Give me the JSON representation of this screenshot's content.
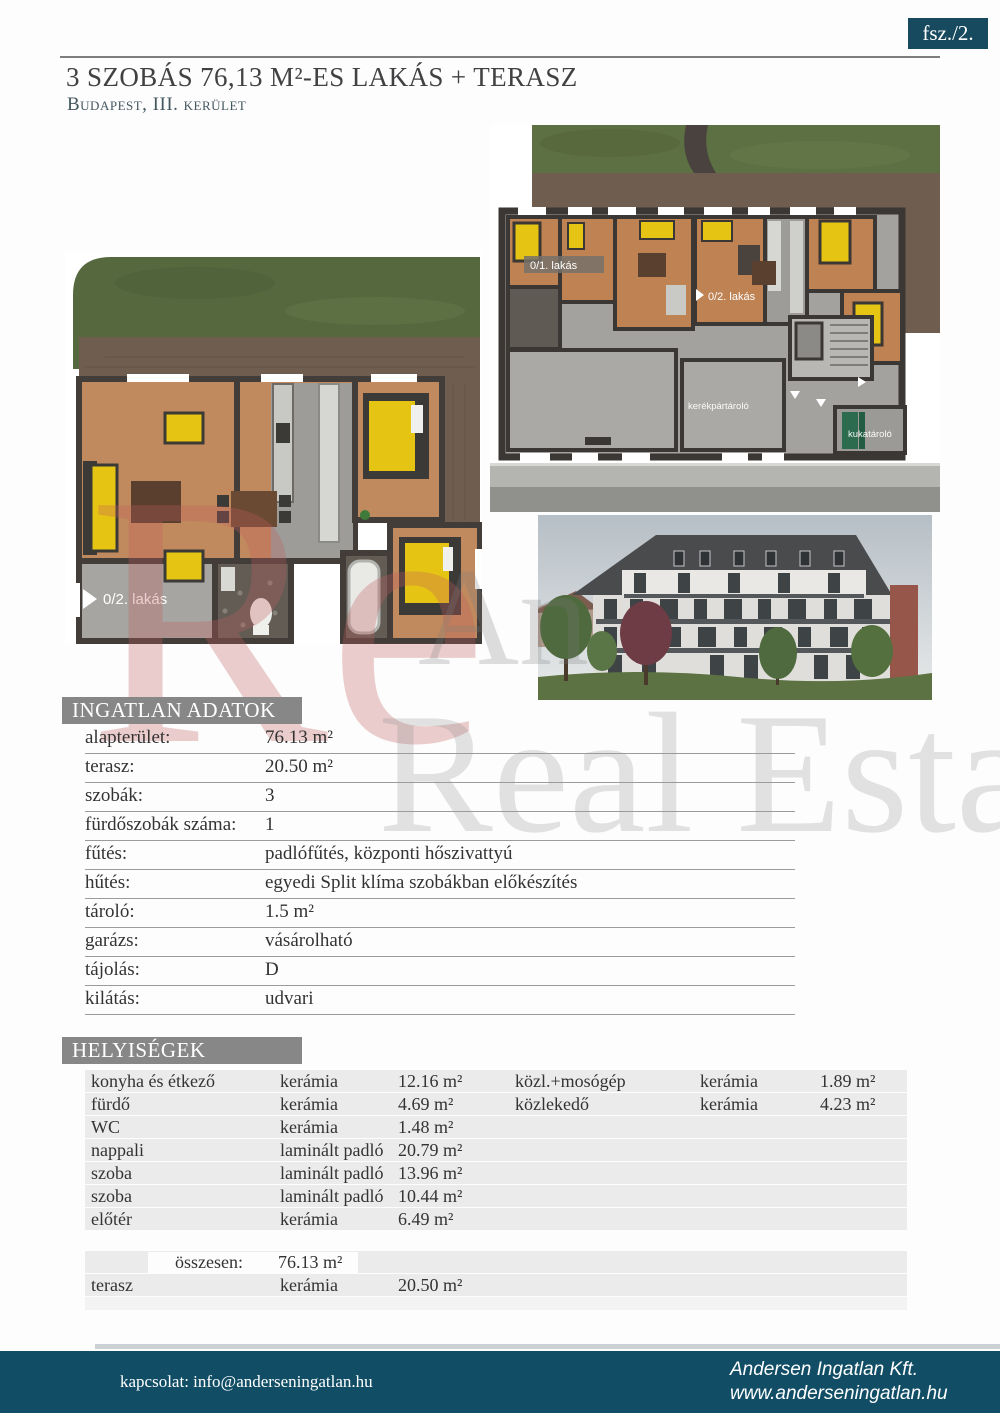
{
  "badge": {
    "label": "fsz./2."
  },
  "header": {
    "title": "3 SZOBÁS 76,13 M²-ES LAKÁS + TERASZ",
    "subtitle": "Budapest, III. kerület"
  },
  "watermark": {
    "monogram": "Re",
    "fragment": "An",
    "line": "Real Estate"
  },
  "floorplan_overview": {
    "apt1_label": "0/1. lakás",
    "apt2_label": "0/2. lakás",
    "bike_label": "kerékpártároló",
    "trash_label": "kukatároló"
  },
  "floorplan_detail": {
    "apt_label": "0/2. lakás"
  },
  "property_data": {
    "section_title": "INGATLAN ADATOK",
    "rows": [
      {
        "label": "alapterület:",
        "value": "76.13 m²"
      },
      {
        "label": "terasz:",
        "value": "20.50 m²"
      },
      {
        "label": "szobák:",
        "value": "3"
      },
      {
        "label": "fürdőszobák száma:",
        "value": "1"
      },
      {
        "label": "fűtés:",
        "value": "padlófűtés, központi hőszivattyú"
      },
      {
        "label": "hűtés:",
        "value": "egyedi Split klíma szobákban előkészítés"
      },
      {
        "label": "tároló:",
        "value": "1.5 m²"
      },
      {
        "label": "garázs:",
        "value": "vásárolható"
      },
      {
        "label": "tájolás:",
        "value": "D"
      },
      {
        "label": "kilátás:",
        "value": "udvari"
      }
    ]
  },
  "rooms": {
    "section_title": "HELYISÉGEK",
    "left_rows": [
      {
        "name": "konyha és étkező",
        "material": "kerámia",
        "area": "12.16 m²"
      },
      {
        "name": "fürdő",
        "material": "kerámia",
        "area": "4.69 m²"
      },
      {
        "name": "WC",
        "material": "kerámia",
        "area": "1.48 m²"
      },
      {
        "name": "nappali",
        "material": "laminált padló",
        "area": "20.79 m²"
      },
      {
        "name": "szoba",
        "material": "laminált padló",
        "area": "13.96 m²"
      },
      {
        "name": "szoba",
        "material": "laminált padló",
        "area": "10.44 m²"
      },
      {
        "name": "előtér",
        "material": "kerámia",
        "area": "6.49 m²"
      }
    ],
    "right_rows": [
      {
        "name": "közl.+mosógép",
        "material": "kerámia",
        "area": "1.89 m²"
      },
      {
        "name": "közlekedő",
        "material": "kerámia",
        "area": "4.23 m²"
      }
    ],
    "total_label": "összesen:",
    "total_value": "76.13 m²",
    "terrace_row": {
      "name": "terasz",
      "material": "kerámia",
      "area": "20.50 m²"
    }
  },
  "footer": {
    "contact": "kapcsolat: info@anderseningatlan.hu",
    "company": "Andersen Ingatlan Kft.",
    "website": "www.anderseningatlan.hu"
  },
  "colors": {
    "accent_teal": "#114e66",
    "bar_gray": "#878787",
    "wood_floor": "#c08a5e",
    "furniture_yellow": "#e6c414",
    "grass_green": "#55683e"
  }
}
